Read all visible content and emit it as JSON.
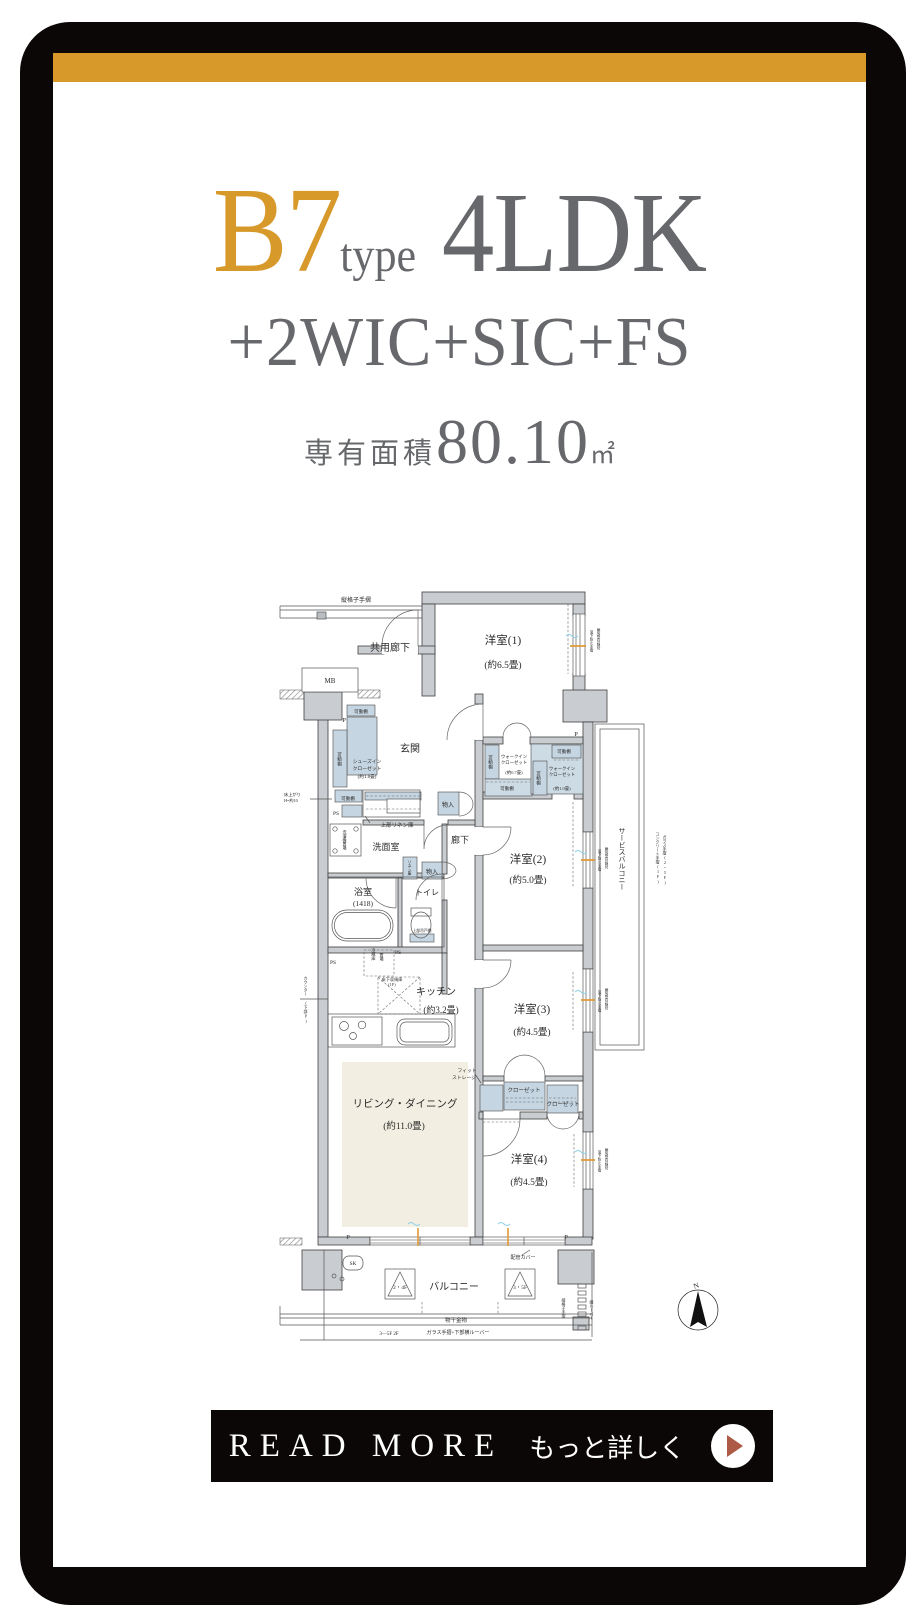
{
  "colors": {
    "accent": "#D8992B",
    "frame": "#0B0706",
    "text_gray": "#67686C",
    "arrow": "#AD5A46",
    "wall_fill": "#c9cdd1",
    "closet_fill": "#c5d5e1",
    "tatami_fill": "#f2efe2"
  },
  "title": {
    "plan_code": "B7",
    "plan_code_suffix": "type",
    "layout": "4LDK",
    "options": "+2WIC+SIC+FS",
    "area_label": "専有面積",
    "area_value": "80.10",
    "area_unit": "㎡"
  },
  "cta": {
    "read_more_label": "READ MORE",
    "detail_label": "もっと詳しく"
  },
  "floorplan": {
    "labels": [
      {
        "n": "label-railing-top",
        "t": "縦格子手摺",
        "x": 86,
        "y": 40,
        "s": 6
      },
      {
        "n": "label-common-corridor",
        "t": "共用廊下",
        "x": 120,
        "y": 89,
        "s": 10
      },
      {
        "n": "label-mb",
        "t": "MB",
        "x": 60,
        "y": 121,
        "s": 7
      },
      {
        "n": "label-bedroom1",
        "t": "洋室(1)",
        "x": 233,
        "y": 82,
        "s": 11.5
      },
      {
        "n": "label-bedroom1-size",
        "t": "(約6.5畳)",
        "x": 233,
        "y": 106,
        "s": 9.5
      },
      {
        "n": "label-genkan",
        "t": "玄関",
        "x": 140,
        "y": 190,
        "s": 10
      },
      {
        "t": "可動棚",
        "x": 91,
        "y": 151,
        "s": 4.6
      },
      {
        "t": "可動棚",
        "x": 70,
        "y": 197,
        "s": 4.6,
        "v": true
      },
      {
        "t": "シューズイン",
        "x": 97,
        "y": 201,
        "s": 4.8
      },
      {
        "t": "クローゼット",
        "x": 97,
        "y": 208,
        "s": 4.8
      },
      {
        "t": "(約1.8畳)",
        "x": 97,
        "y": 216,
        "s": 4.8
      },
      {
        "t": "可動棚",
        "x": 78,
        "y": 238,
        "s": 4.6
      },
      {
        "t": "P",
        "x": 74,
        "y": 160,
        "s": 6.5
      },
      {
        "t": "床上がり",
        "x": 14,
        "y": 234,
        "s": 4.2,
        "a": "start"
      },
      {
        "t": "H=約10",
        "x": 14,
        "y": 240,
        "s": 4.2,
        "a": "start"
      },
      {
        "t": "PS",
        "x": 66,
        "y": 253,
        "s": 5.5
      },
      {
        "t": "上部リネン庫",
        "x": 127,
        "y": 265,
        "s": 5.5
      },
      {
        "t": "洗濯機置場",
        "x": 75,
        "y": 278,
        "s": 4,
        "v": true
      },
      {
        "n": "label-senmen",
        "t": "洗面室",
        "x": 116,
        "y": 288,
        "s": 9
      },
      {
        "t": "物入",
        "x": 178,
        "y": 245,
        "s": 6
      },
      {
        "t": "リネン庫",
        "x": 140,
        "y": 306,
        "s": 3.8,
        "v": true
      },
      {
        "t": "物入",
        "x": 162,
        "y": 312,
        "s": 6
      },
      {
        "n": "label-hallway",
        "t": "廊下",
        "x": 190,
        "y": 281,
        "s": 9
      },
      {
        "t": "可動棚",
        "x": 221,
        "y": 200,
        "s": 4.6,
        "v": true
      },
      {
        "t": "ウォークイン",
        "x": 244,
        "y": 196,
        "s": 4.4
      },
      {
        "t": "クローゼット",
        "x": 244,
        "y": 202,
        "s": 4.4
      },
      {
        "t": "(約0.7畳)",
        "x": 244,
        "y": 212,
        "s": 4.4
      },
      {
        "t": "可動棚",
        "x": 237,
        "y": 228,
        "s": 4.6
      },
      {
        "t": "可動棚",
        "x": 294,
        "y": 191,
        "s": 4.6
      },
      {
        "t": "可動棚",
        "x": 269,
        "y": 216,
        "s": 4.6,
        "v": true
      },
      {
        "t": "ウォークイン",
        "x": 292,
        "y": 208,
        "s": 4.4
      },
      {
        "t": "クローゼット",
        "x": 292,
        "y": 214,
        "s": 4.4
      },
      {
        "t": "(約1.0畳)",
        "x": 292,
        "y": 228,
        "s": 4.4
      },
      {
        "t": "P",
        "x": 306,
        "y": 174,
        "s": 6.5
      },
      {
        "n": "label-bedroom2",
        "t": "洋室(2)",
        "x": 258,
        "y": 301,
        "s": 11.5
      },
      {
        "n": "label-bedroom2-size",
        "t": "(約5.0畳)",
        "x": 258,
        "y": 321,
        "s": 9.5
      },
      {
        "n": "label-bath",
        "t": "浴室",
        "x": 93,
        "y": 333,
        "s": 9
      },
      {
        "t": "(1418)",
        "x": 93,
        "y": 344,
        "s": 7.5
      },
      {
        "n": "label-toilet",
        "t": "トイレ",
        "x": 157,
        "y": 333,
        "s": 8
      },
      {
        "t": "上部吊戸棚",
        "x": 152,
        "y": 370,
        "s": 3.8
      },
      {
        "t": "PS",
        "x": 63,
        "y": 402,
        "s": 5.5
      },
      {
        "t": "PS",
        "x": 128,
        "y": 392,
        "s": 5.5
      },
      {
        "t": "冷蔵庫",
        "x": 104,
        "y": 392,
        "s": 4.2,
        "v": true
      },
      {
        "t": "置場",
        "x": 112,
        "y": 395,
        "s": 4.2,
        "v": true
      },
      {
        "t": "床下収納庫",
        "x": 122,
        "y": 419,
        "s": 4.2
      },
      {
        "t": "(1F)",
        "x": 122,
        "y": 424,
        "s": 4.2
      },
      {
        "n": "label-kitchen",
        "t": "キッチン",
        "x": 166,
        "y": 433,
        "s": 10
      },
      {
        "n": "label-kitchen-size",
        "t": "(約3.2畳)",
        "x": 171,
        "y": 451,
        "s": 9
      },
      {
        "t": "カウンター",
        "x": 36,
        "y": 424,
        "s": 4,
        "v": true
      },
      {
        "t": "(下部P)",
        "x": 36,
        "y": 450,
        "s": 4,
        "v": true
      },
      {
        "n": "label-bedroom3",
        "t": "洋室(3)",
        "x": 262,
        "y": 451,
        "s": 11.5
      },
      {
        "n": "label-bedroom3-size",
        "t": "(約4.5畳)",
        "x": 262,
        "y": 473,
        "s": 9.5
      },
      {
        "n": "label-living",
        "t": "リビング・ダイニング",
        "x": 135,
        "y": 545,
        "s": 10.5
      },
      {
        "n": "label-living-size",
        "t": "(約11.0畳)",
        "x": 134,
        "y": 567,
        "s": 9.5
      },
      {
        "t": "フィット",
        "x": 197,
        "y": 510,
        "s": 4.8
      },
      {
        "t": "ストレージ",
        "x": 194,
        "y": 517,
        "s": 4.8
      },
      {
        "t": "クローゼット",
        "x": 254,
        "y": 530,
        "s": 5.5
      },
      {
        "t": "クローゼット",
        "x": 293,
        "y": 544,
        "s": 5.5
      },
      {
        "n": "label-bedroom4",
        "t": "洋室(4)",
        "x": 259,
        "y": 601,
        "s": 11.5
      },
      {
        "n": "label-bedroom4-size",
        "t": "(約4.5畳)",
        "x": 259,
        "y": 623,
        "s": 9.5
      },
      {
        "n": "label-service-balcony",
        "t": "サービスバルコニー",
        "x": 352,
        "y": 297,
        "s": 7,
        "v": true
      },
      {
        "t": "コンクリート手摺(1F)",
        "x": 388,
        "y": 296,
        "s": 4,
        "v": true
      },
      {
        "t": "ガラス手摺(2~5F)",
        "x": 395,
        "y": 298,
        "s": 4,
        "v": true
      },
      {
        "t": "開放型目隠付",
        "x": 329,
        "y": 77,
        "s": 3.6,
        "v": true
      },
      {
        "t": "落下防止手摺",
        "x": 322,
        "y": 79,
        "s": 3.6,
        "v": true
      },
      {
        "t": "開放型目隠付",
        "x": 337,
        "y": 296,
        "s": 3.6,
        "v": true
      },
      {
        "t": "落下防止手摺",
        "x": 330,
        "y": 298,
        "s": 3.6,
        "v": true
      },
      {
        "t": "開放型目隠付",
        "x": 337,
        "y": 437,
        "s": 3.6,
        "v": true
      },
      {
        "t": "落下防止手摺",
        "x": 330,
        "y": 439,
        "s": 3.6,
        "v": true
      },
      {
        "t": "開放型目隠付",
        "x": 337,
        "y": 597,
        "s": 3.6,
        "v": true
      },
      {
        "t": "落下防止手摺",
        "x": 330,
        "y": 599,
        "s": 3.6,
        "v": true
      },
      {
        "t": "P",
        "x": 78,
        "y": 677,
        "s": 6.5
      },
      {
        "t": "P",
        "x": 296,
        "y": 677,
        "s": 6.5
      },
      {
        "t": "SK",
        "x": 83,
        "y": 703,
        "s": 5.5
      },
      {
        "t": "配管カバー",
        "x": 253,
        "y": 697,
        "s": 5
      },
      {
        "t": "2・4F",
        "x": 130,
        "y": 727,
        "s": 5.5
      },
      {
        "n": "label-balcony",
        "t": "バルコニー",
        "x": 184,
        "y": 728,
        "s": 10
      },
      {
        "t": "3・5F",
        "x": 250,
        "y": 727,
        "s": 5.5
      },
      {
        "t": "物干金物",
        "x": 186,
        "y": 760,
        "s": 5.5
      },
      {
        "t": "縦格子手摺",
        "x": 294,
        "y": 746,
        "s": 4,
        "v": true
      },
      {
        "t": "縦ルーバー",
        "x": 322,
        "y": 748,
        "s": 4,
        "v": true
      },
      {
        "t": "3—5F 2F",
        "x": 119,
        "y": 773,
        "s": 5
      },
      {
        "t": "ガラス手摺+下部横ルーバー",
        "x": 188,
        "y": 772,
        "s": 5
      },
      {
        "n": "compass-n-label",
        "t": "N",
        "x": 427,
        "y": 726,
        "s": 7.5,
        "r": -18
      }
    ]
  }
}
